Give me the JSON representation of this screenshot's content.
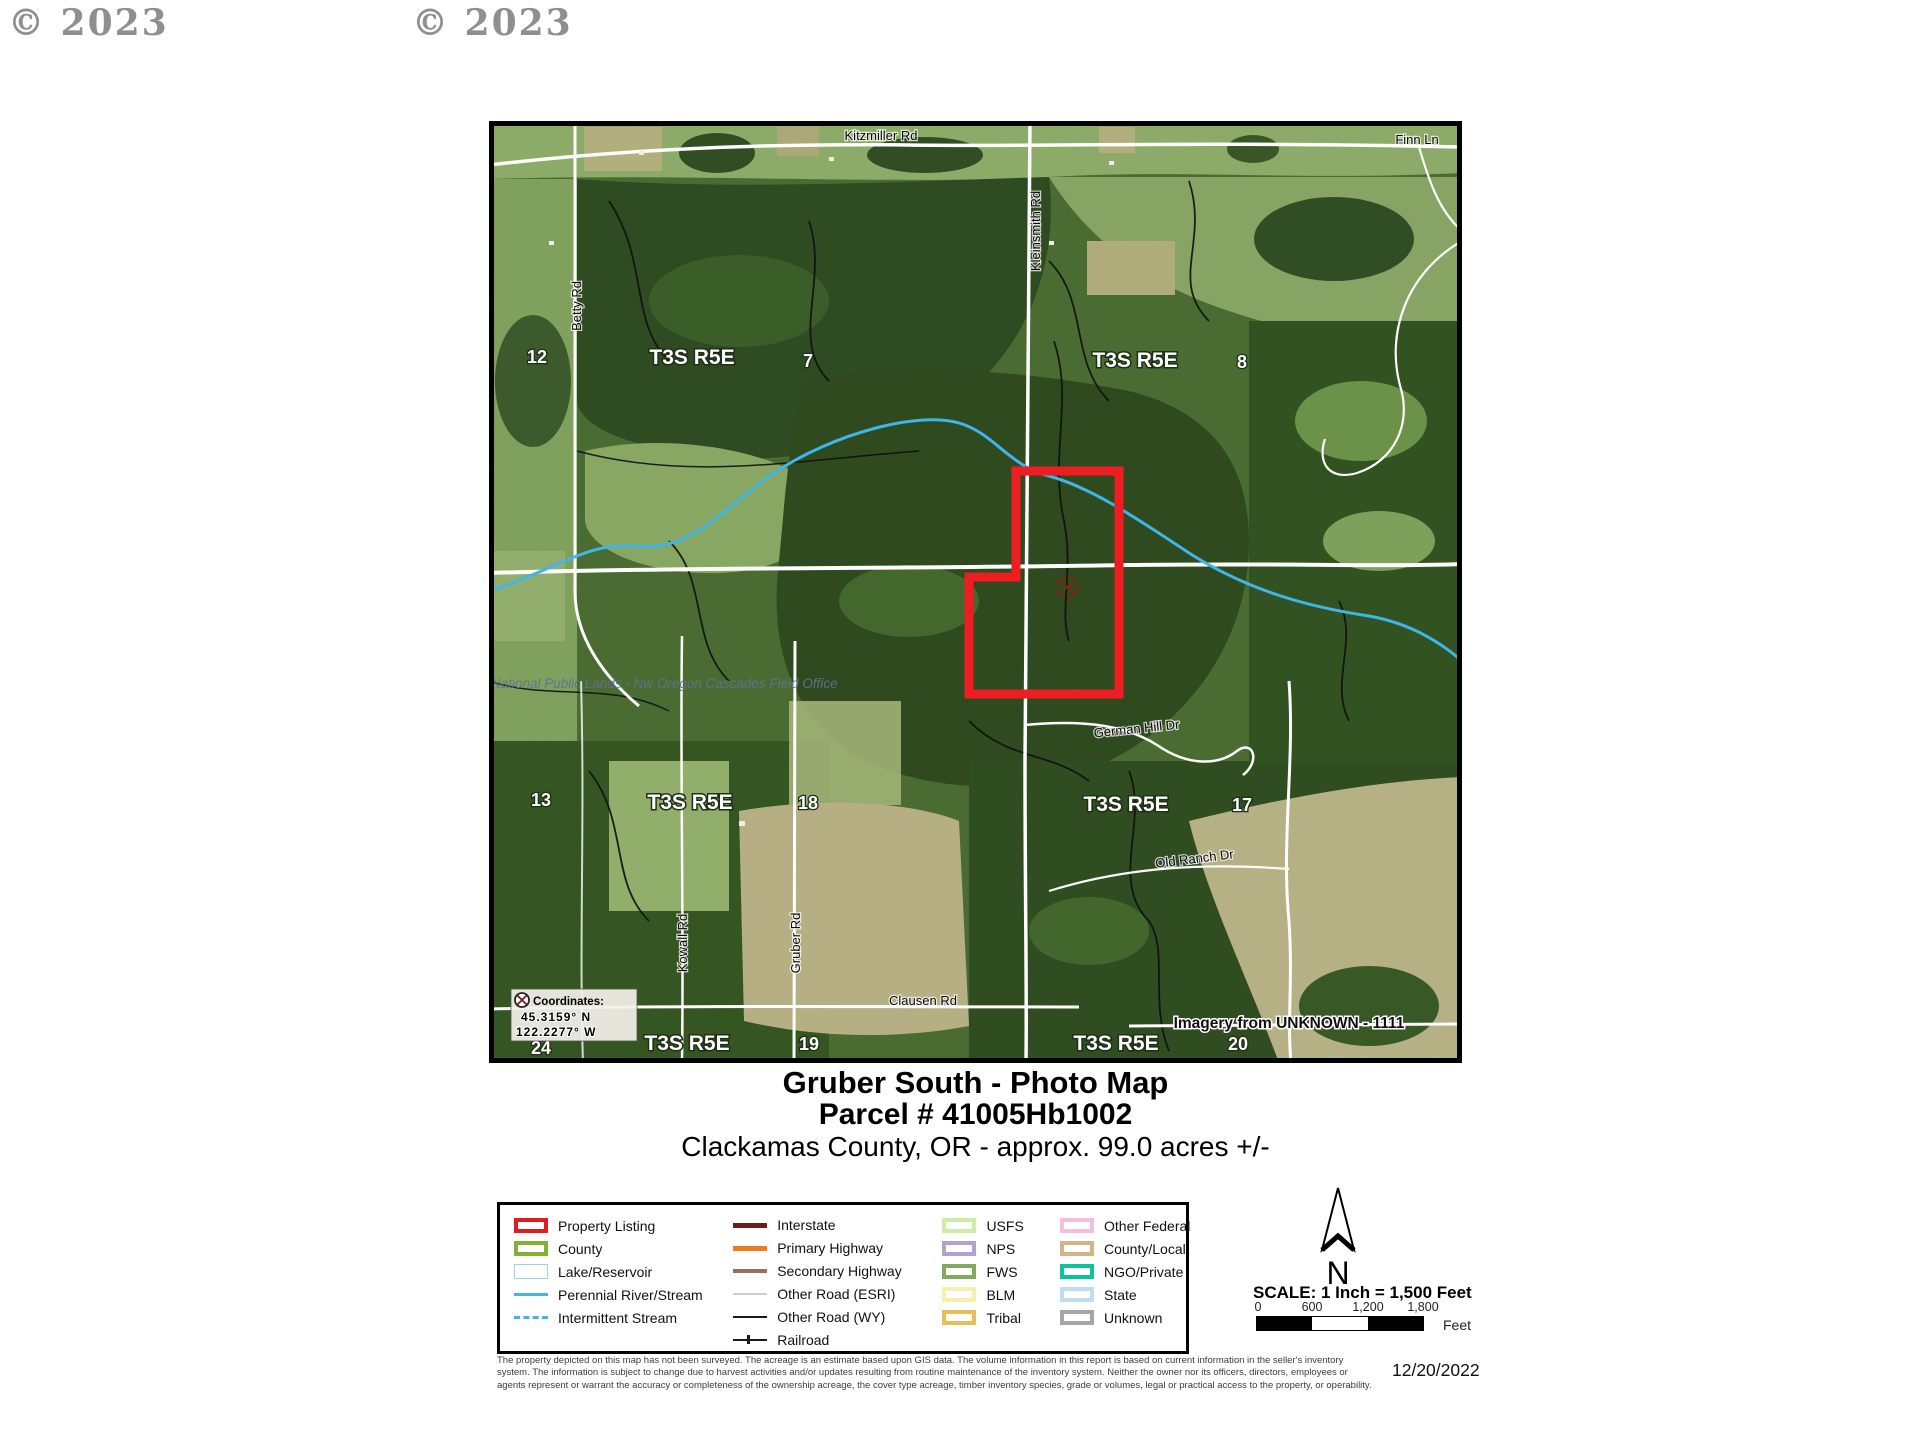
{
  "copyright": {
    "one": "© 2023",
    "two": "© 2023"
  },
  "map": {
    "township": [
      "T3S R5E",
      "T3S R5E",
      "T3S R5E",
      "T3S R5E",
      "T3S R5E",
      "T3S R5E"
    ],
    "sections": [
      "12",
      "7",
      "8",
      "13",
      "18",
      "17",
      "24",
      "19",
      "20"
    ],
    "roads": {
      "kitzmiller": "Kitzmiller Rd",
      "finn": "Finn Ln",
      "kleinsmith": "Kleinsmith Rd",
      "betty": "Betty Rd",
      "german_hill": "German Hill Dr",
      "old_ranch": "Old Ranch Dr",
      "clausen": "Clausen Rd",
      "gruber": "Gruber Rd",
      "kowall": "Kowall Rd"
    },
    "coordinates": {
      "title": "Coordinates:",
      "lat": "45.3159° N",
      "lon": "122.2277° W"
    },
    "imagery_credit": "Imagery from UNKNOWN - 1111",
    "watermark": "National Public Lands - Nw Oregon Cascades Field Office",
    "parcel_color": "#ee1d23"
  },
  "title_block": {
    "line1": "Gruber South - Photo Map",
    "line2": "Parcel # 41005Hb1002",
    "line3": "Clackamas County, OR - approx. 99.0 acres +/-"
  },
  "legend": {
    "areas": [
      {
        "label": "Property Listing",
        "color": "#e11c20"
      },
      {
        "label": "County",
        "color": "#84b135"
      },
      {
        "label": "Lake/Reservoir",
        "color": "#9fd4ea"
      },
      {
        "label": "Perennial River/Stream",
        "color": "#45b5e0"
      },
      {
        "label": "Intermittent Stream",
        "color": "#45b5e0"
      }
    ],
    "lines": [
      {
        "label": "Interstate",
        "color": "#6d1c1c"
      },
      {
        "label": "Primary Highway",
        "color": "#f07c22"
      },
      {
        "label": "Secondary Highway",
        "color": "#96705a"
      },
      {
        "label": "Other Road (ESRI)",
        "color": "#cfcfcf"
      },
      {
        "label": "Other Road (WY)",
        "color": "#1a1a1a"
      },
      {
        "label": "Railroad",
        "color": "#1a1a1a"
      }
    ],
    "federal1": [
      {
        "label": "USFS",
        "color": "#cdeca6"
      },
      {
        "label": "NPS",
        "color": "#b5a0d4"
      },
      {
        "label": "FWS",
        "color": "#82aa5e"
      },
      {
        "label": "BLM",
        "color": "#f6f0ae"
      },
      {
        "label": "Tribal",
        "color": "#e9bd5a"
      }
    ],
    "federal2": [
      {
        "label": "Other Federal",
        "color": "#f6bede"
      },
      {
        "label": "County/Local",
        "color": "#d3b488"
      },
      {
        "label": "NGO/Private",
        "color": "#0cc39a"
      },
      {
        "label": "State",
        "color": "#bedcf2"
      },
      {
        "label": "Unknown",
        "color": "#a6a6a6"
      }
    ]
  },
  "north": {
    "label": "N"
  },
  "scale": {
    "title": "SCALE:  1 Inch = 1,500 Feet",
    "ticks": [
      "0",
      "600",
      "1,200",
      "1,800"
    ],
    "unit": "Feet"
  },
  "disclaimer": {
    "line1": "The property depicted on this map has not been surveyed.   The acreage is an estimate based upon GIS data.  The volume information in this report is based on current information in the seller's inventory",
    "line2": "system.   The information is subject to change due to harvest activities and/or updates resulting from routine maintenance of the inventory system.  Neither the owner nor its officers, directors, employees or",
    "line3": "agents represent or warrant the accuracy or completeness of the ownership acreage, the cover type acreage, timber inventory species, grade or volumes, legal or practical access to the property, or operability."
  },
  "date": "12/20/2022"
}
